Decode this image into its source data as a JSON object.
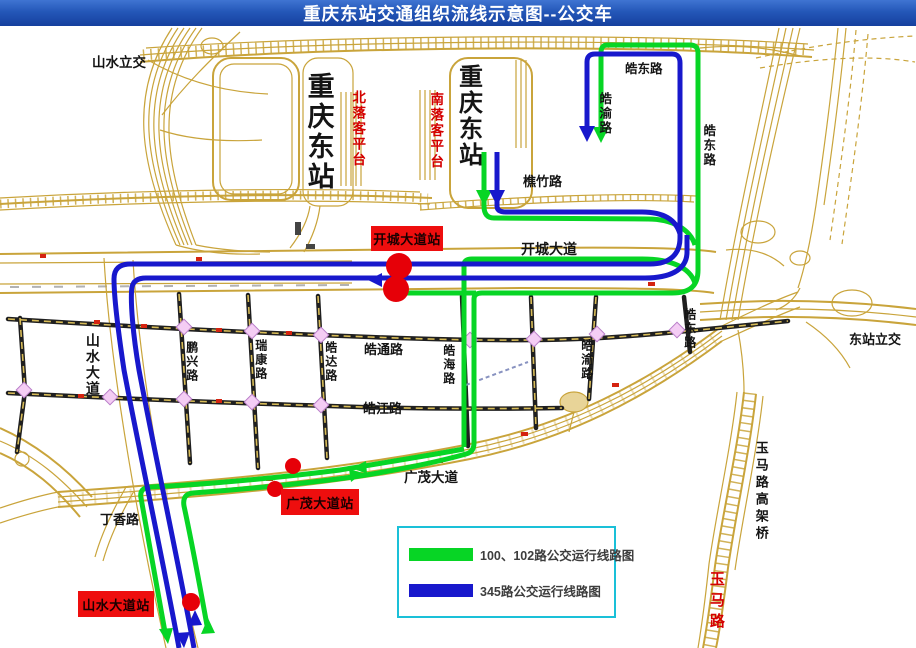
{
  "title": "重庆东站交通组织流线示意图--公交车",
  "colors": {
    "title_bar": "#2457b8",
    "route_green": "#07d525",
    "route_blue": "#1818cc",
    "road_tan": "#c9a43b",
    "station_box_red": "#ee0e0e",
    "red_label_text": "#d40000",
    "legend_border": "#1ac0d8",
    "bus_stop_red": "#e60008",
    "intersection_pink": "#f4cdf4"
  },
  "map_labels": {
    "shanshui_lijiao": "山水立交",
    "chongqing_east_station_left": "重庆东站",
    "chongqing_east_station_right": "重庆东站",
    "north_dropoff_platform": "北落客平台",
    "south_dropoff_platform": "南落客平台",
    "haodong_rd_top": "皓东路",
    "haoyu_rd_top": "皓渝路",
    "haodong_rd_topright": "皓东路",
    "qiaozhu_rd": "樵竹路",
    "kaicheng_ave": "开城大道",
    "dongzhan_lijiao": "东站立交",
    "shanshui_ave": "山水大道",
    "pengxing_rd": "鹏兴路",
    "ruikang_rd": "瑞康路",
    "haoda_rd": "皓达路",
    "haotong_rd": "皓通路",
    "haohai_rd": "皓海路",
    "haojiang_rd": "皓江路",
    "haoyu_rd_mid": "皓渝路",
    "haodong_rd_mid": "皓东路",
    "guangmao_ave": "广茂大道",
    "dingxiang_rd": "丁香路",
    "yuma_viaduct": "玉马路高架桥",
    "yuma_rd": "玉马路"
  },
  "stations": {
    "kaicheng_station": "开城大道站",
    "guangmao_station": "广茂大道站",
    "shanshui_station": "山水大道站"
  },
  "legend": {
    "items": [
      {
        "label": "100、102路公交运行线路图",
        "color": "#07d525"
      },
      {
        "label": "345路公交运行线路图",
        "color": "#1818cc"
      }
    ]
  }
}
